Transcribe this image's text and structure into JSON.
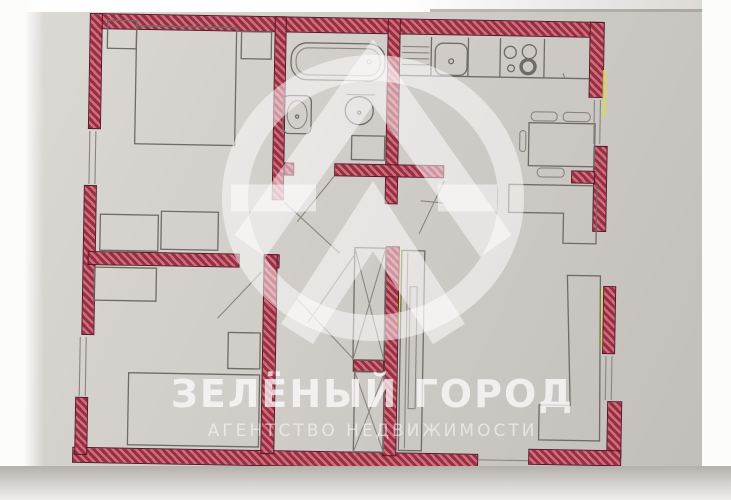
{
  "watermark": {
    "title": "ЗЕЛЁНЫЙ ГОРОД",
    "subtitle": "АГЕНТСТВО  НЕДВИЖИМОСТИ",
    "logo": "ring-with-double-chevron-emblem"
  },
  "colors": {
    "paper": "#d4d0cb",
    "paper_light": "#e9e7e4",
    "photo_margin": "#fcfcfb",
    "wall_fill": "#9b2c41",
    "wall_hatch": "#c8717d",
    "wall_outline": "#571626",
    "pencil": "#6f6b66",
    "pencil_light": "#8a8580",
    "highlight_yellow": "#d6d46e",
    "watermark_white": "#ffffff"
  },
  "plan_elements": [
    "double-bed",
    "nightstand",
    "dresser",
    "bathtub",
    "bathroom-sink",
    "toilet",
    "washing-machine",
    "dish-rack",
    "kitchen-sink",
    "stove",
    "dining-table",
    "chair",
    "corner-sofa",
    "built-in-closet",
    "wardrobe",
    "corner-cabinet",
    "single-bed",
    "shelf",
    "window",
    "door-swing"
  ]
}
